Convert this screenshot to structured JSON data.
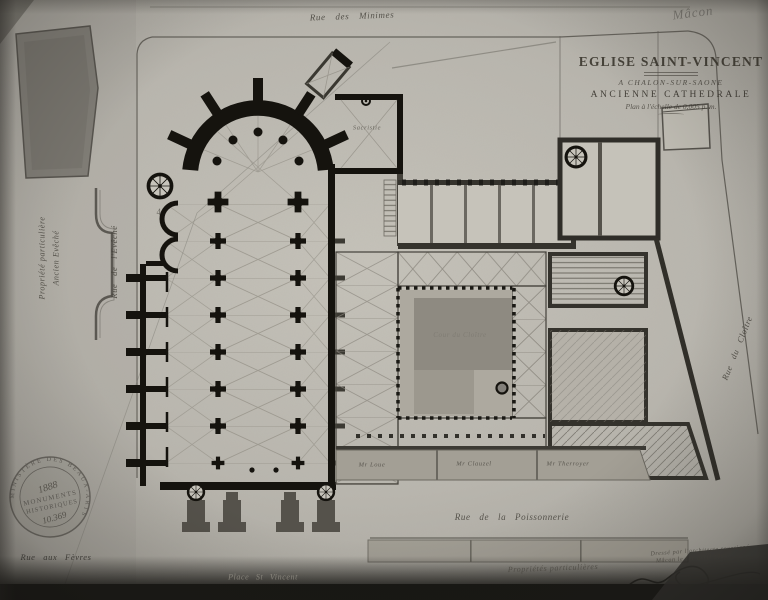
{
  "document": {
    "corner_note": "Mâcon",
    "pencil_numeral": "4"
  },
  "title_block": {
    "line1": "EGLISE SAINT-VINCENT",
    "line2": "A CHALON-SUR-SAONE",
    "line3": "ANCIENNE CATHEDRALE",
    "line4": "Plan à l'échelle de 0,005 p. m."
  },
  "streets": {
    "minimes": "Rue des Minimes",
    "eveche": "Rue de l'Evêché",
    "cloitre": "Rue du Cloître",
    "poissonnerie": "Rue de la Poissonnerie",
    "fevres": "Rue aux Fèvres",
    "place_st_vincent": "Place St Vincent"
  },
  "properties": {
    "left_line1": "Propriété particulière",
    "left_line2": "Ancien Evêché",
    "bottom": "Propriétés particulières",
    "owners": [
      "Mr Loue",
      "Mr Clauzel",
      "Mr Therroyer"
    ]
  },
  "plan_labels": {
    "sacristie": "Sacristie",
    "courtyard": "Cour du Cloître"
  },
  "stamp": {
    "ring_text": "MINISTÈRE DES BEAUX-ARTS",
    "year": "1888",
    "line1": "MONUMENTS",
    "line2": "HISTORIQUES",
    "number": "10.369"
  },
  "signature": {
    "line1": "Dressé par l'architecte soussigné",
    "line2": "Mâcon le 1er avril 1888"
  },
  "colors": {
    "paper": "#b9b6ae",
    "ink": "#15130e",
    "wall_gray": "#4a473f",
    "wash": "#9b978d"
  }
}
